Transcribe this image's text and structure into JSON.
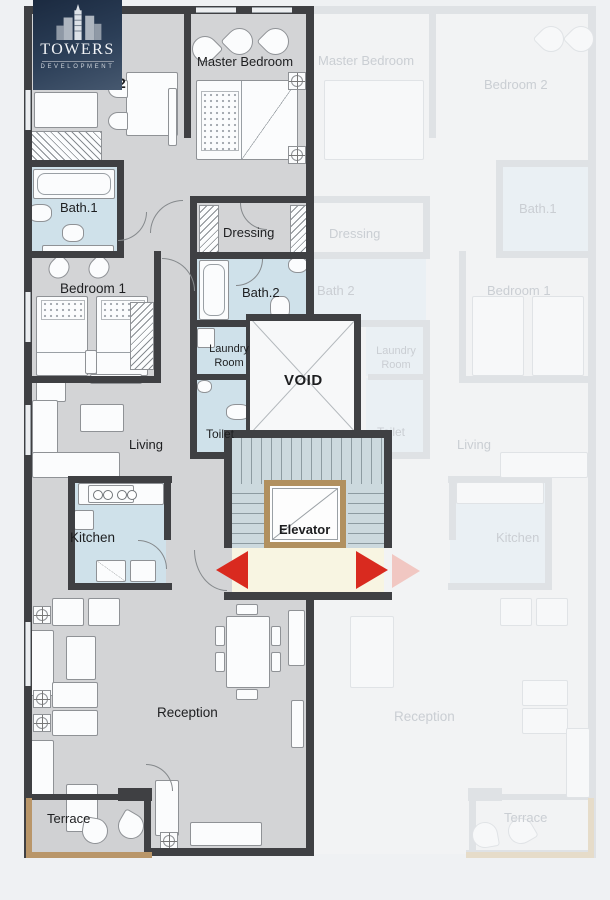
{
  "logo": {
    "brand": "TOWERS",
    "tagline": "DEVELOPMENT"
  },
  "unit": {
    "master_bedroom": "Master Bedroom",
    "bedroom2_suffix": "2",
    "bath1": "Bath.1",
    "bedroom1": "Bedroom 1",
    "dressing": "Dressing",
    "bath2": "Bath.2",
    "laundry_room": "Laundry Room",
    "void": "VOID",
    "toilet": "Toilet",
    "living": "Living",
    "kitchen": "Kitchen",
    "elevator": "Elevator",
    "reception": "Reception",
    "terrace": "Terrace"
  },
  "mirror_unit": {
    "master_bedroom": "Master Bedroom",
    "bedroom2": "Bedroom 2",
    "bath1": "Bath.1",
    "dressing": "Dressing",
    "bath2": "Bath 2",
    "bedroom1": "Bedroom 1",
    "laundry_room": "Laundry Room",
    "toilet": "Toilet",
    "living": "Living",
    "kitchen": "Kitchen",
    "reception": "Reception",
    "terrace": "Terrace"
  },
  "colors": {
    "wall": "#3f4043",
    "floor": "#d3d4d6",
    "wet_room": "#cfe1ea",
    "stairs": "#ccd9de",
    "landing": "#f8f5e2",
    "elevator_frame": "#b1905f",
    "arrow_red": "#d92a1f",
    "logo_bg": "#24344b",
    "terrace_rail": "#b99669"
  }
}
